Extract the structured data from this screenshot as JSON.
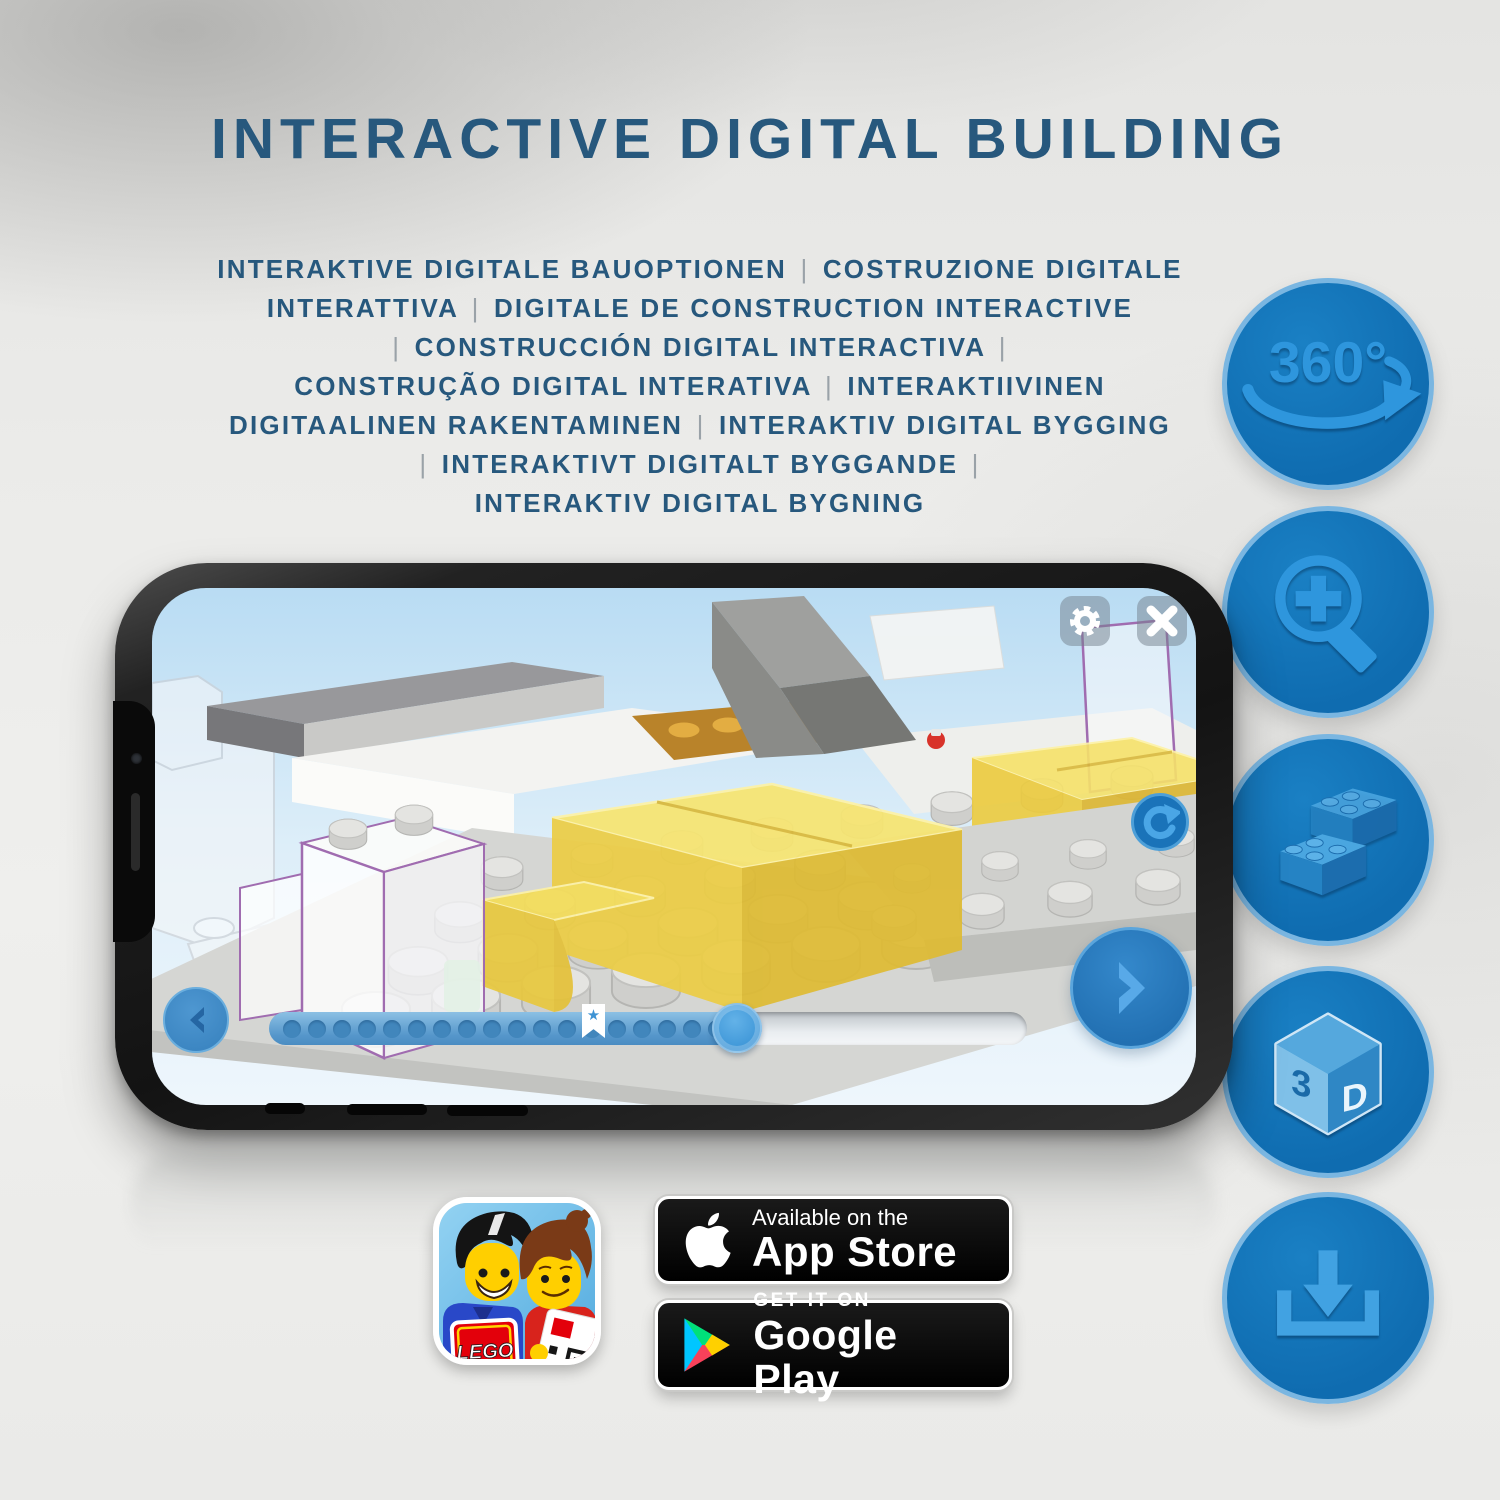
{
  "header": {
    "title": "INTERACTIVE DIGITAL BUILDING"
  },
  "subtitle": {
    "lines": [
      "INTERAKTIVE DIGITALE BAUOPTIONEN | COSTRUZIONE DIGITALE",
      "INTERATTIVA | DIGITALE DE CONSTRUCTION INTERACTIVE",
      "| CONSTRUCCIÓN DIGITAL INTERACTIVA |",
      "CONSTRUÇÃO DIGITAL INTERATIVA | INTERAKTIIVINEN",
      "DIGITAALINEN RAKENTAMINEN | INTERAKTIV DIGITAL BYGGING",
      "| INTERAKTIVT DIGITALT BYGGANDE |",
      "INTERAKTIV DIGITAL BYGNING"
    ]
  },
  "features": [
    {
      "name": "360-degree-rotation",
      "text": "360°"
    },
    {
      "name": "zoom-in"
    },
    {
      "name": "brick-assembly"
    },
    {
      "name": "3d-view",
      "face_left": "3",
      "face_right": "D"
    },
    {
      "name": "download"
    }
  ],
  "phone": {
    "app": {
      "progress": {
        "dot_count": 19,
        "filled_ratio": 0.63,
        "bookmark_star": "★"
      }
    }
  },
  "badges": {
    "app_store": {
      "tagline": "Available on the",
      "store_name": "App Store"
    },
    "google_play": {
      "tagline": "GET IT ON",
      "store_name": "Google Play"
    }
  },
  "lego_app": {
    "logo_text": "LEGO"
  },
  "colors": {
    "headline_blue": "#27587d",
    "circle_fill": "#0f6cb0",
    "circle_ring": "#7ab6e1",
    "icon_glyph": "#2e96dd",
    "highlight_yellow": "#f2d74e",
    "ui_button_blue": "#2b7cc0",
    "pipe_grey": "#9aa2a8"
  }
}
